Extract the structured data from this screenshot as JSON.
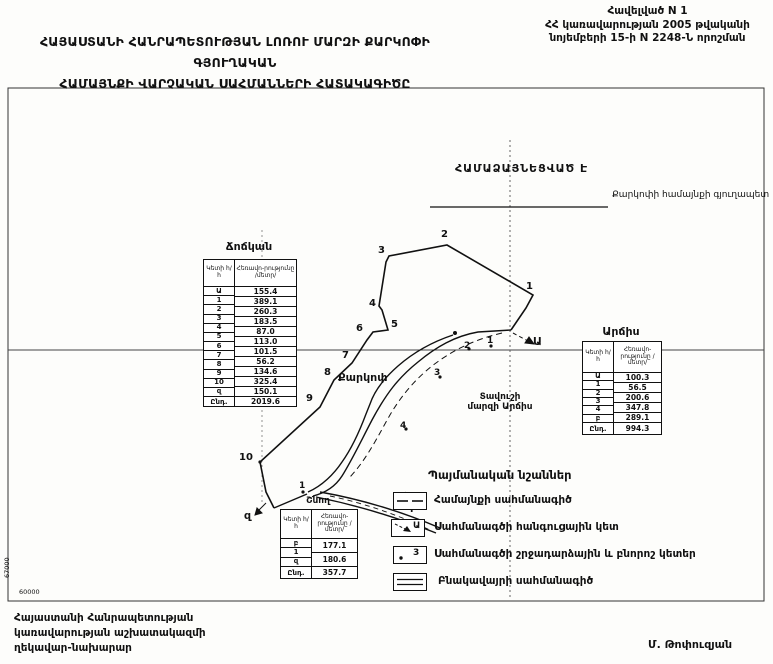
{
  "header": {
    "appendix_line1": "Հավելված N 1",
    "appendix_line2": "ՀՀ կառավարության 2005 թվականի",
    "appendix_line3": "նոյեմբերի 15-ի N 2248-Ն որոշման",
    "title_line1": "ՀԱՅԱՍՏԱՆԻ ՀԱՆՐԱՊԵՏՈՒԹՅԱՆ ԼՈՌՈՒ ՄԱՐԶԻ ՔԱՐԿՈՓԻ ԳՅՈՒՂԱԿԱՆ",
    "title_line2": "ՀԱՄԱՅՆՔԻ ՎԱՐՉԱԿԱՆ ՍԱՀՄԱՆՆԵՐԻ ՀԱՏԱԿԱԳԻԾԸ"
  },
  "approval": {
    "agreed_label": "ՀԱՄԱՁԱՅՆԵՑՎԱԾ Է",
    "signatory_title": "Քարկոփի համայնքի գյուղապետ"
  },
  "tables": {
    "col_point": "Կետի հ/հ",
    "col_distance": "Հեռավո-րությունը /մետր/",
    "total_label": "Ընդ.",
    "chochkan": {
      "title": "Ճոճկան",
      "point_labels": [
        "Ա",
        "1",
        "2",
        "3",
        "4",
        "5",
        "6",
        "7",
        "8",
        "9",
        "10",
        "զ"
      ],
      "distances": [
        "155.4",
        "389.1",
        "260.3",
        "183.5",
        "87.0",
        "113.0",
        "101.5",
        "56.2",
        "134.6",
        "325.4",
        "150.1"
      ],
      "total": "2019.6"
    },
    "archis": {
      "title": "Արճիս",
      "point_labels": [
        "Ա",
        "1",
        "2",
        "3",
        "4",
        "բ"
      ],
      "distances": [
        "100.3",
        "56.5",
        "200.6",
        "347.8",
        "289.1"
      ],
      "total": "994.3"
    },
    "shnogh": {
      "title": "Շնող",
      "point_labels": [
        "բ",
        "1",
        "զ"
      ],
      "distances": [
        "177.1",
        "180.6"
      ],
      "total": "357.7"
    }
  },
  "map": {
    "settlement_label": "Քարկոփ",
    "neighbor_tavush_line1": "Տավուշի",
    "neighbor_tavush_line2": "մարզի Արճիս",
    "junction_a": "Ա",
    "junction_z": "զ",
    "junction_b": "բ",
    "outer_points": [
      "1",
      "2",
      "3",
      "4",
      "5",
      "6",
      "7",
      "8",
      "9",
      "10"
    ],
    "inner_points": [
      "1",
      "2",
      "3",
      "4"
    ],
    "shnogh_point": "1",
    "scale_label": "60000",
    "grid_label": "67000"
  },
  "legend": {
    "title": "Պայմանական նշաններ",
    "item1": "Համայնքի սահմանագիծ",
    "item2": "Սահմանագծի հանգուցային կետ",
    "item2_symbol": "Ա",
    "item3": "Սահմանագծի շրջադարձային և բնորոշ կետեր",
    "item3_symbol": "3",
    "item4": "Բնակավայրի սահմանագիծ"
  },
  "footer": {
    "org_line1": "Հայաստանի Հանրապետության",
    "org_line2": "կառավարության աշխատակազմի",
    "org_line3": "ղեկավար-նախարար",
    "signature_name": "Մ. Թոփուզյան"
  }
}
